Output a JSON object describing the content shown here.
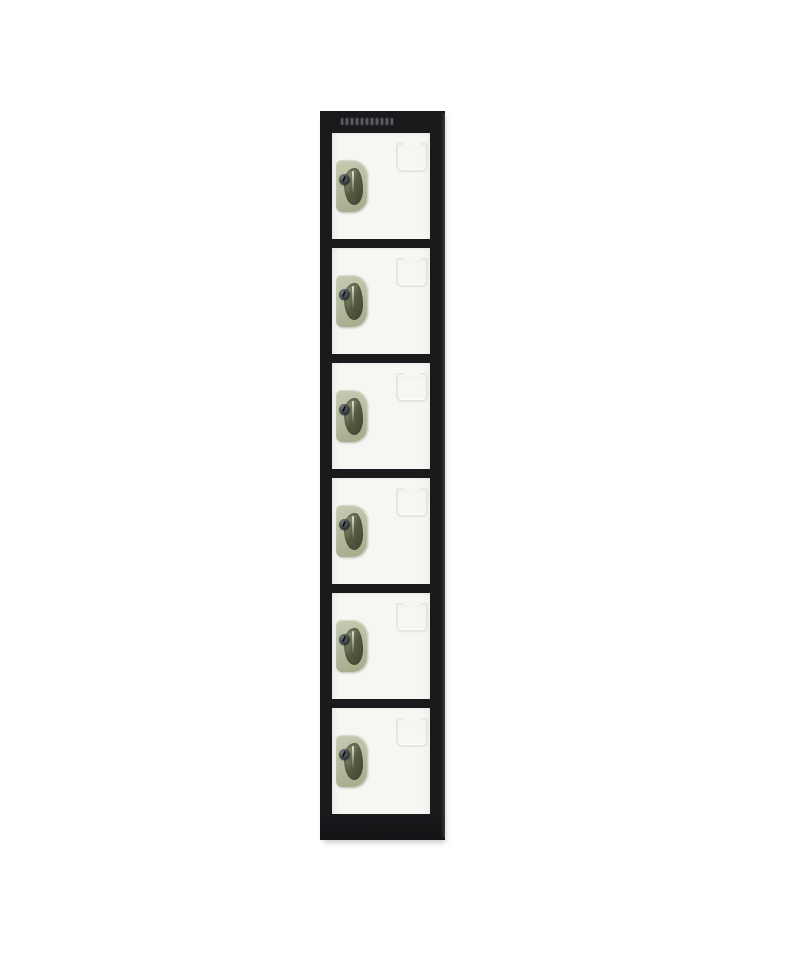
{
  "image": {
    "description": "Studio product photograph of a tall single-column steel locker with six compartments on a plain white background",
    "background_color": "#ffffff"
  },
  "locker": {
    "compartment_count": 6,
    "frame_color": "#1a1a1d",
    "door_color": "#f7f6f3",
    "handle_color": "#b7bda1",
    "handle_recess_color": "#565b43",
    "lock_color": "#33373a",
    "card_holder_line_color": "#e6e5e0",
    "compartments": [
      {
        "position": 1
      },
      {
        "position": 2
      },
      {
        "position": 3
      },
      {
        "position": 4
      },
      {
        "position": 5
      },
      {
        "position": 6
      }
    ]
  },
  "icons": {
    "brand_mark": "illegible-brand-logo",
    "lock": "cam-lock-keyhole-icon",
    "card_holder": "embossed-label-holder-outline"
  }
}
